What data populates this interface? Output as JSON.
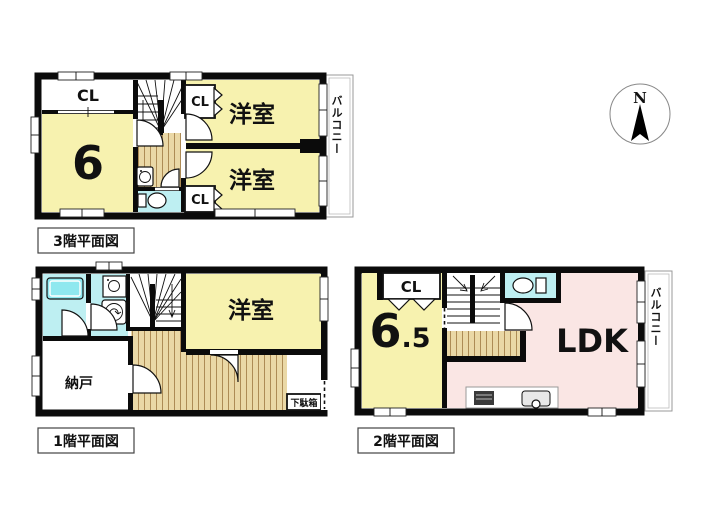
{
  "colors": {
    "room_yellow": "#F7F2AF",
    "ldk_pink": "#FAE6E4",
    "water_cyan": "#BEEFF2",
    "bathtub_cyan": "#8FE8EF",
    "wood_floor": "#EAD8A6",
    "wood_stripe": "#AD8B55",
    "wall_black": "#0B0B0B",
    "balcony_border": "#999999"
  },
  "compass": {
    "north_label": "N"
  },
  "floor3": {
    "title": "3階平面図",
    "closet_top_left": "CL",
    "tatami_room": "6",
    "western_room_top": "洋室",
    "western_room_bottom": "洋室",
    "closet_right_top": "CL",
    "closet_right_bottom": "CL",
    "balcony": "バルコニー"
  },
  "floor1": {
    "title": "1階平面図",
    "western_room": "洋室",
    "storage_room": "納戸",
    "shoe_cabinet": "下駄箱"
  },
  "floor2": {
    "title": "2階平面図",
    "closet": "CL",
    "room_size_main": "6",
    "room_size_fraction": ".5",
    "living": "LDK",
    "balcony": "バルコニー"
  }
}
